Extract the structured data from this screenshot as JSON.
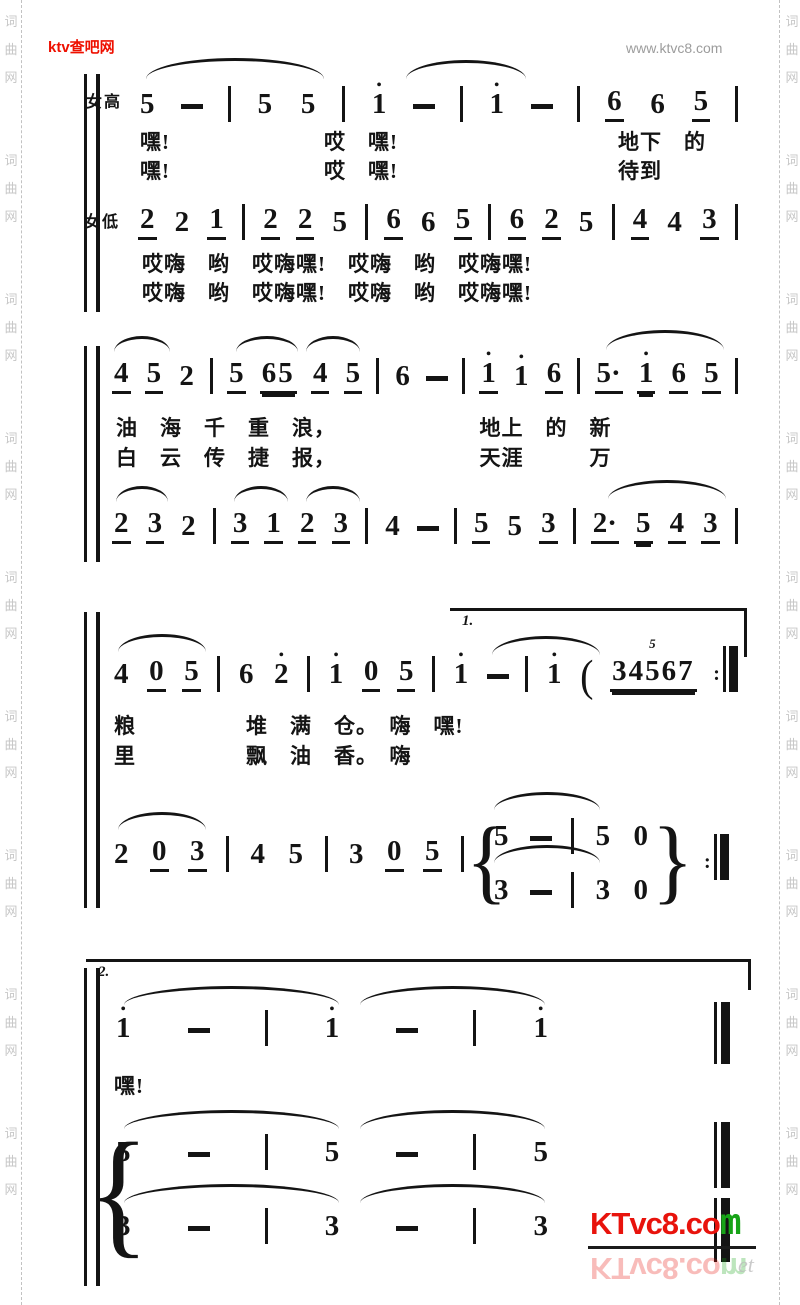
{
  "header": {
    "site_left": "ktv查吧网",
    "site_right": "www.ktvc8.com",
    "left_color": "#ee1000",
    "right_color": "#9c9c9c"
  },
  "border": {
    "chars": [
      "词",
      "曲",
      "网"
    ],
    "color": "#c7c7c7"
  },
  "labels": {
    "soprano": "女高",
    "alto": "女低",
    "volta1": "1.",
    "volta2": "2."
  },
  "music": {
    "ink_color": "#141414",
    "brace_open": "{",
    "brace_close": "}",
    "sys1_upper": [
      "5",
      "-",
      "|",
      "5",
      "5",
      "|",
      "1'",
      "-",
      "|",
      "1'",
      "-",
      "|",
      "6_",
      "6",
      "5_",
      "|"
    ],
    "sys1_lower": [
      "2_",
      "2",
      "1_",
      "|",
      "2_",
      "2_",
      "5",
      "|",
      "6_",
      "6",
      "5_",
      "|",
      "6_",
      "2_",
      "5",
      "|",
      "4_",
      "4",
      "3_",
      "|"
    ],
    "sys2_upper": [
      "4_",
      "5_",
      "2",
      "|",
      "5_",
      "65__",
      "4_",
      "5_",
      "|",
      "6",
      "-",
      "|",
      "1'_",
      "1'",
      "6_",
      "|",
      "5·_",
      "1'__",
      "6_",
      "5_",
      "|"
    ],
    "sys2_lower": [
      "2_",
      "3_",
      "2",
      "|",
      "3_",
      "1_",
      "2_",
      "3_",
      "|",
      "4",
      "-",
      "|",
      "5_",
      "5",
      "3_",
      "|",
      "2·_",
      "5__",
      "4_",
      "3_",
      "|"
    ],
    "sys3_upper": [
      "4",
      "0_",
      "5_",
      "|",
      "6",
      "2'",
      "|",
      "1'",
      "0_",
      "5_",
      "|",
      "1'",
      "-",
      "|",
      "1'",
      "(",
      "34567__^5",
      ":||"
    ],
    "sys3_lower": [
      "2",
      "0_",
      "3_",
      "|",
      "4",
      "5",
      "|",
      "3",
      "0_",
      "5_",
      "|"
    ],
    "sys3_end_upper": [
      "5",
      "-",
      "|",
      "5",
      "0"
    ],
    "sys3_end_lower": [
      "3",
      "-",
      "|",
      "3",
      "0"
    ],
    "sys3_end_repeat": [
      ":||"
    ],
    "sys4_upper": [
      "1'",
      "-",
      "|",
      "1'",
      "-",
      "|",
      "1'"
    ],
    "sys4_mid": [
      "5",
      "-",
      "|",
      "5",
      "-",
      "|",
      "5"
    ],
    "sys4_low": [
      "3",
      "-",
      "|",
      "3",
      "-",
      "|",
      "3"
    ],
    "final_bar": [
      "END"
    ]
  },
  "lyrics": {
    "l1a": "嘿!　　　　　　　哎　嘿!　　　　　　　　　　地下　的",
    "l1b": "嘿!　　　　　　　哎　嘿!　　　　　　　　　　待到",
    "l1c": "哎嗨　哟　哎嗨嘿!　哎嗨　哟　哎嗨嘿!",
    "l1d": "哎嗨　哟　哎嗨嘿!　哎嗨　哟　哎嗨嘿!",
    "l2a": "油　海　千　重　浪，　　　　　　　地上　的　新",
    "l2b": "白　云　传　捷　报，　　　　　　　天涯　　　万",
    "l3a": "粮　　　　　堆　满　仓。　嗨　嘿!",
    "l3b": "里　　　　　飘　油　香。　嗨",
    "l4a": "嘿!"
  },
  "watermark": {
    "main_red": "KTvc8.co",
    "main_green": "m",
    "reflection_red": "KTvc8.co",
    "reflection_green": "m",
    "reflection_extra": "et",
    "red": "#e8130c",
    "green": "#17a317"
  }
}
